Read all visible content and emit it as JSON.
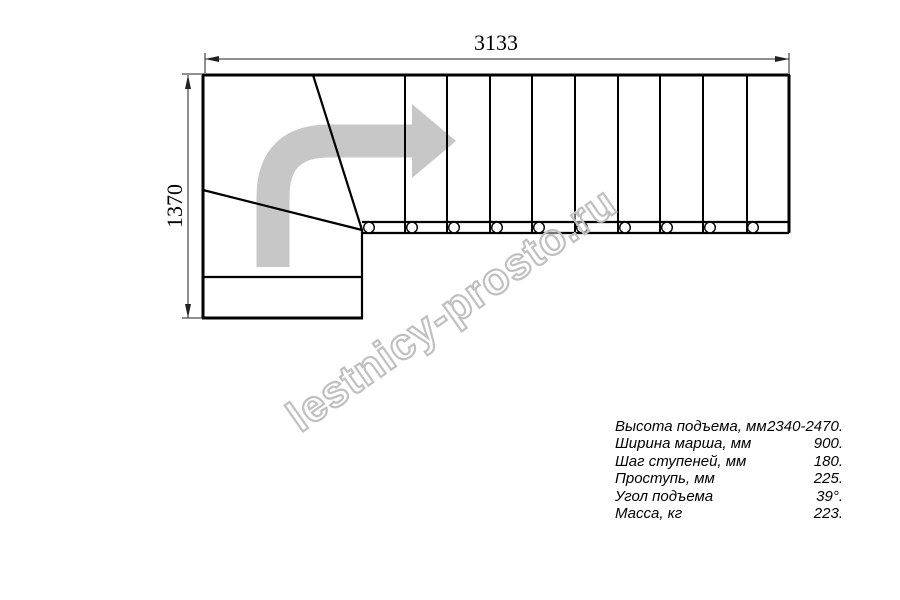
{
  "drawing": {
    "title": "staircase-plan-view",
    "dimension_width_mm": "3133",
    "dimension_height_mm": "1370",
    "straight_flight_treads": 10,
    "winder_treads": 3,
    "baluster_count": 10
  },
  "watermark": {
    "text": "lestnicy-prosto.ru"
  },
  "specs": {
    "rows": [
      {
        "label": "Высота подъема, мм",
        "value": "2340-2470."
      },
      {
        "label": "Ширина марша, мм",
        "value": "900."
      },
      {
        "label": "Шаг ступеней, мм",
        "value": "180."
      },
      {
        "label": "Проступь, мм",
        "value": "225."
      },
      {
        "label": "Угол подъема",
        "value": "39°."
      },
      {
        "label": "Масса, кг",
        "value": "223."
      }
    ]
  },
  "colors": {
    "line": "#000000",
    "dim": "#222222",
    "arrow": "#c7c7c7",
    "watermark": "#c0c0c0"
  }
}
